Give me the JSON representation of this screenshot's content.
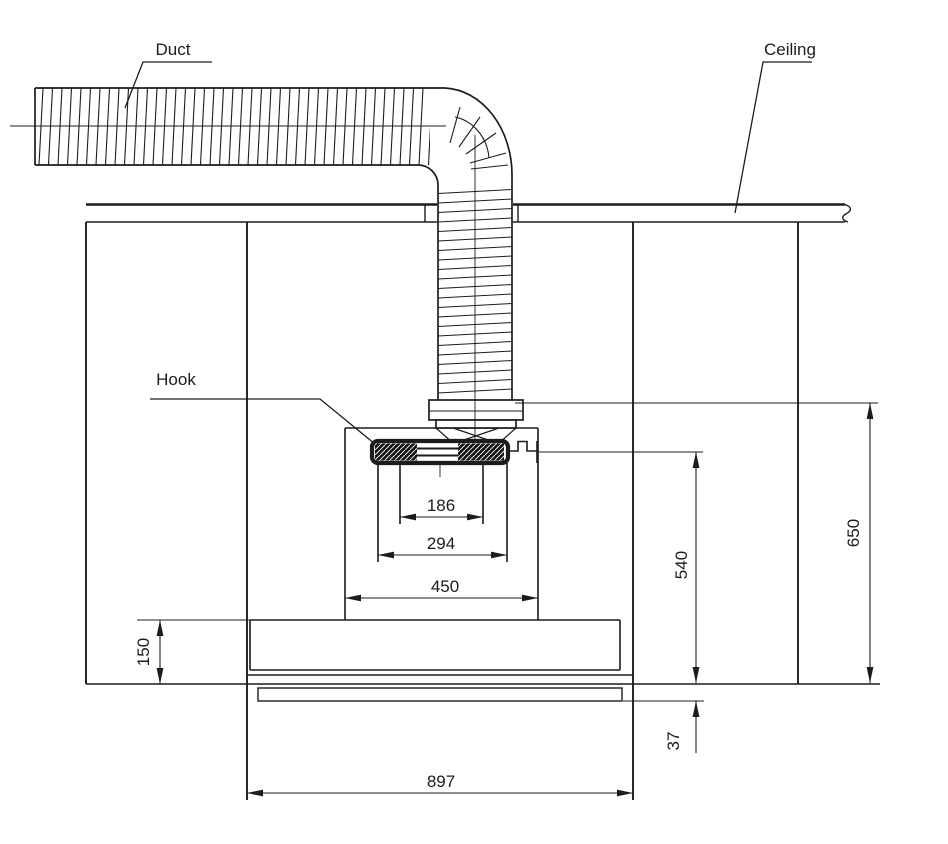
{
  "drawing": {
    "labels": {
      "duct": "Duct",
      "ceiling": "Ceiling",
      "hook": "Hook"
    },
    "dimensions": {
      "flue_inner_width": "186",
      "flue_outer_width": "294",
      "recess_width": "450",
      "hook_to_bottom_height": "540",
      "top_to_bottom_height": "650",
      "lower_section_height": "150",
      "panel_offset": "37",
      "overall_width": "897"
    },
    "colors": {
      "line": "#1c1c1e",
      "background": "#ffffff"
    }
  }
}
